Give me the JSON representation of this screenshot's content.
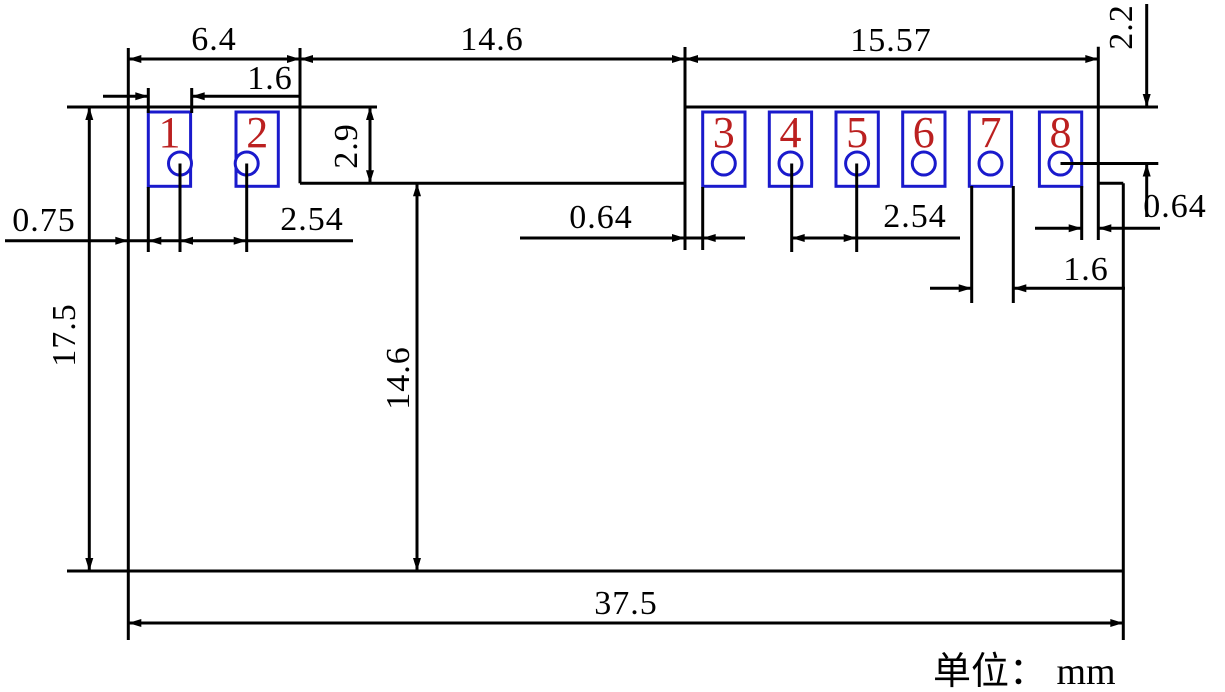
{
  "drawing": {
    "unit_note": "单位： mm",
    "pad_numbers": [
      "1",
      "2",
      "3",
      "4",
      "5",
      "6",
      "7",
      "8"
    ],
    "dimensions": {
      "top_left_width": "6.4",
      "top_middle_width": "14.6",
      "top_right_width": "15.57",
      "pad1_width": "1.6",
      "left_edge_to_pad1": "0.75",
      "left_hole_pitch": "2.54",
      "step_to_pad3_gap": "0.64",
      "right_hole_pitch": "2.54",
      "pad8_to_right_edge_gap": "0.64",
      "pad7_width": "1.6",
      "overall_height": "17.5",
      "body_height": "14.6",
      "pad_section_height": "2.9",
      "top_edge_to_hole8": "2.2",
      "overall_width": "37.5"
    },
    "colors": {
      "line": "#000000",
      "pad_outline": "#1a1acc",
      "pad_number": "#bb2020",
      "background": "#ffffff"
    }
  }
}
